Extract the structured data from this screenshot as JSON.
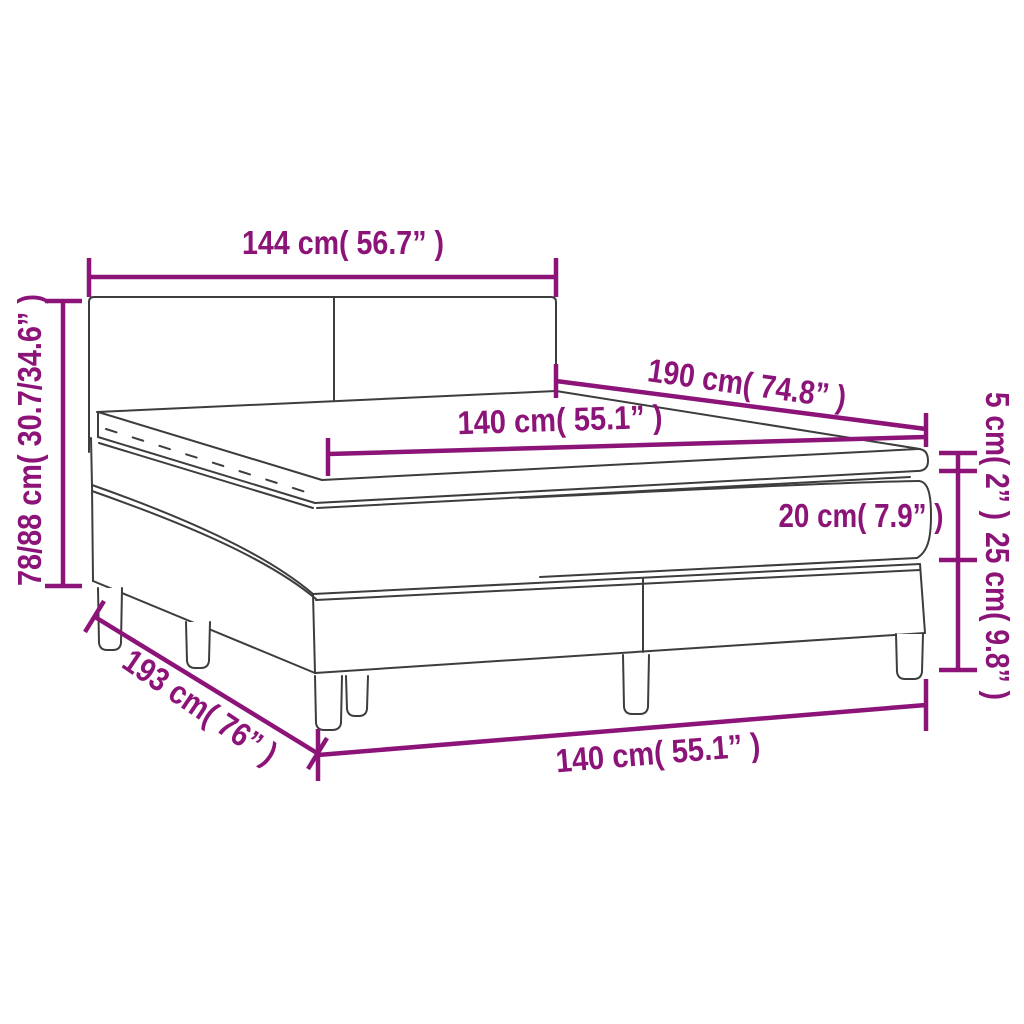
{
  "diagram": {
    "product": "box spring bed with headboard, mattress and topper — dimension diagram",
    "colors": {
      "dimension_lines": "#8c1478",
      "bed_outline": "#3d3d3d",
      "background": "#ffffff"
    },
    "measurements": {
      "headboard_width": "144 cm( 56.7” )",
      "overall_height": "78/88 cm( 30.7/34.6” )",
      "mattress_length": "190 cm( 74.8” )",
      "mattress_width_top": "140 cm( 55.1” )",
      "topper_height": "5 cm( 2” )",
      "mattress_height": "20 cm( 7.9” )",
      "base_height": "25 cm( 9.8” )",
      "base_length": "193 cm( 76” )",
      "base_width_bottom": "140 cm( 55.1” )"
    }
  }
}
